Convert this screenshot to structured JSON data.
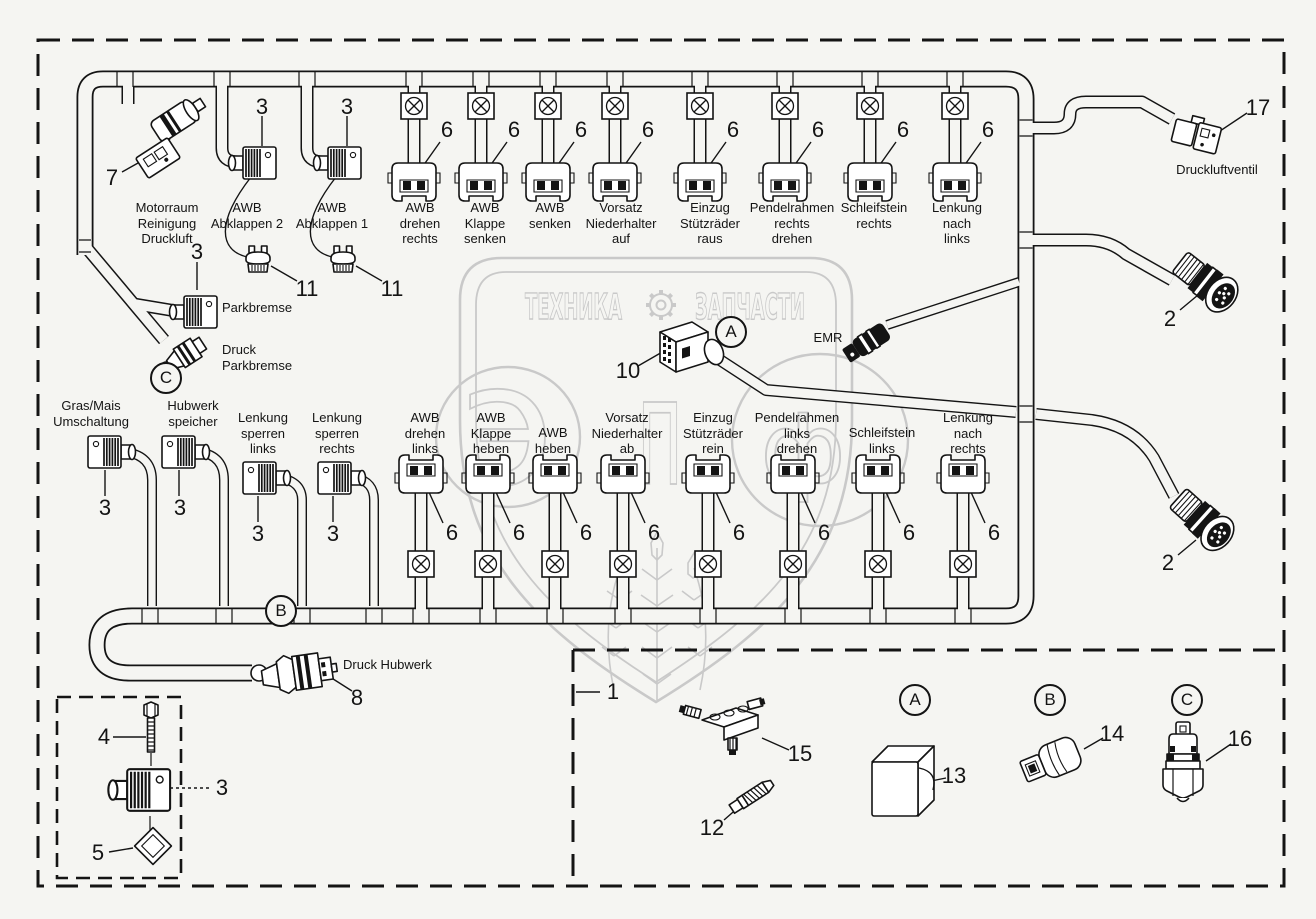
{
  "colors": {
    "line": "#141414",
    "background": "#f5f5f2",
    "watermark": "#c9c9c9"
  },
  "watermark": {
    "banner_left": "ТЕХНИКА",
    "banner_right": "ЗАПЧАСТИ",
    "glyph_e": "э",
    "glyph_p": "п",
    "glyph_f": "ф"
  },
  "refs": {
    "a": "A",
    "b": "B",
    "c": "C"
  },
  "top_row": [
    {
      "id": "motorraum",
      "label": "Motorraum\nReinigung\nDruckluft",
      "callout": "7"
    },
    {
      "id": "awb-abklappen-2",
      "label": "AWB\nAbklappen 2",
      "callout": "3",
      "cap_callout": "11"
    },
    {
      "id": "awb-abklappen-1",
      "label": "AWB\nAbklappen 1",
      "callout": "3",
      "cap_callout": "11"
    },
    {
      "id": "awb-drehen-rechts",
      "label": "AWB\ndrehen\nrechts",
      "callout": "6"
    },
    {
      "id": "awb-klappe-senken",
      "label": "AWB\nKlappe\nsenken",
      "callout": "6"
    },
    {
      "id": "awb-senken",
      "label": "AWB\nsenken",
      "callout": "6"
    },
    {
      "id": "vorsatz-niederhalter-auf",
      "label": "Vorsatz\nNiederhalter\nauf",
      "callout": "6"
    },
    {
      "id": "einzug-stuetzraeder-raus",
      "label": "Einzug\nStützräder\nraus",
      "callout": "6"
    },
    {
      "id": "pendelrahmen-rechts-drehen",
      "label": "Pendelrahmen\nrechts\ndrehen",
      "callout": "6"
    },
    {
      "id": "schleifstein-rechts",
      "label": "Schleifstein\nrechts",
      "callout": "6"
    },
    {
      "id": "lenkung-nach-links",
      "label": "Lenkung\nnach\nlinks",
      "callout": "6"
    }
  ],
  "middle": {
    "parkbremse": "Parkbremse",
    "parkbremse_callout": "3",
    "druck_parkbremse": "Druck\nParkbremse",
    "connector_callout": "10",
    "emr": "EMR"
  },
  "bottom_row": [
    {
      "id": "gras-mais",
      "label": "Gras/Mais\nUmschaltung",
      "callout": "3"
    },
    {
      "id": "hubwerk-speicher",
      "label": "Hubwerk\nspeicher",
      "callout": "3"
    },
    {
      "id": "lenkung-sperren-links",
      "label": "Lenkung\nsperren\nlinks",
      "callout": "3"
    },
    {
      "id": "lenkung-sperren-rechts",
      "label": "Lenkung\nsperren\nrechts",
      "callout": "3"
    },
    {
      "id": "awb-drehen-links",
      "label": "AWB\ndrehen\nlinks",
      "callout": "6"
    },
    {
      "id": "awb-klappe-heben",
      "label": "AWB\nKlappe\nheben",
      "callout": "6"
    },
    {
      "id": "awb-heben",
      "label": "AWB\nheben",
      "callout": "6"
    },
    {
      "id": "vorsatz-niederhalter-ab",
      "label": "Vorsatz\nNiederhalter\nab",
      "callout": "6"
    },
    {
      "id": "einzug-stuetzraeder-rein",
      "label": "Einzug\nStützräder\nrein",
      "callout": "6"
    },
    {
      "id": "pendelrahmen-links-drehen",
      "label": "Pendelrahmen\nlinks\ndrehen",
      "callout": "6"
    },
    {
      "id": "schleifstein-links",
      "label": "Schleifstein\nlinks",
      "callout": "6"
    },
    {
      "id": "lenkung-nach-rechts",
      "label": "Lenkung\nnach\nrechts",
      "callout": "6"
    }
  ],
  "right_side": {
    "druckluftventil": "Druckluftventil",
    "druckluftventil_callout": "17",
    "round_top_callout": "2",
    "round_bottom_callout": "2"
  },
  "hubwerk": {
    "label": "Druck Hubwerk",
    "callout": "8"
  },
  "inset": {
    "bolt": "4",
    "connector": "3",
    "seal": "5"
  },
  "parts": {
    "harness": "1",
    "manifold": "15",
    "plug_screw": "12",
    "relay_box": "13",
    "pressure_switch": "14",
    "pressure_sensor": "16"
  }
}
